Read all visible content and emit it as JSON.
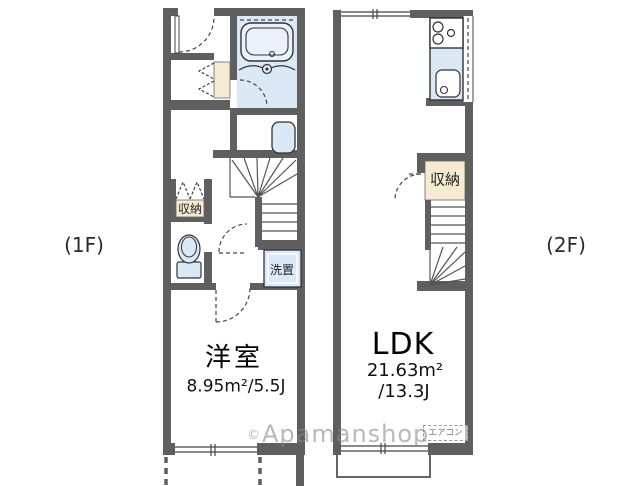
{
  "floor1": {
    "label": "(1F)",
    "room": {
      "name": "洋室",
      "size": "8.95m²/5.5J"
    },
    "closet_label": "収納",
    "laundry_label": "洗置"
  },
  "floor2": {
    "label": "(2F)",
    "room": {
      "name": "LDK",
      "size_m2": "21.63m²",
      "size_j": "/13.3J"
    },
    "closet_label": "収納",
    "aircon_label": "エアコン"
  },
  "watermark": {
    "prefix": "©",
    "text": "Apamanshop"
  },
  "colors": {
    "wall": "#5f5f5f",
    "fixture_blue": "#dbe8f6",
    "closet_beige": "#f4ebd1",
    "line": "#444444",
    "watermark_gray": "#8a8a8a"
  }
}
